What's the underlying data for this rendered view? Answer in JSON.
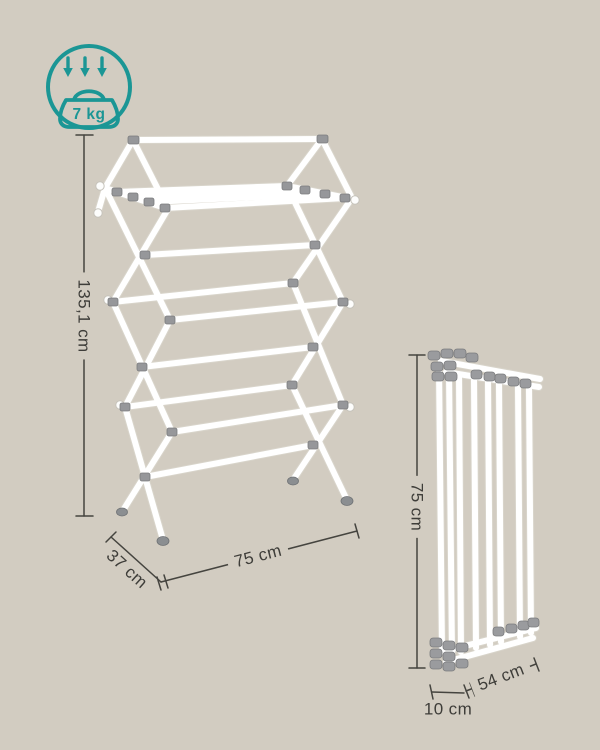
{
  "canvas": {
    "background_color": "#d2ccc1",
    "description": "product dimension diagram of a white foldable clothes drying rack"
  },
  "badge": {
    "capacity_label": "7 kg",
    "color": "#1b9695"
  },
  "illustration": {
    "expanded_rack_alt": "expanded accordion drying rack, white tubes with gray joints",
    "folded_rack_alt": "same rack folded flat, vertical white poles with gray caps"
  },
  "dimensions": {
    "line_color": "#45443f",
    "text_color": "#3e3d39",
    "expanded": {
      "height": "135,1 cm",
      "width": "75 cm",
      "depth": "37 cm"
    },
    "folded": {
      "height": "75 cm",
      "length": "54 cm",
      "depth": "10 cm"
    }
  }
}
